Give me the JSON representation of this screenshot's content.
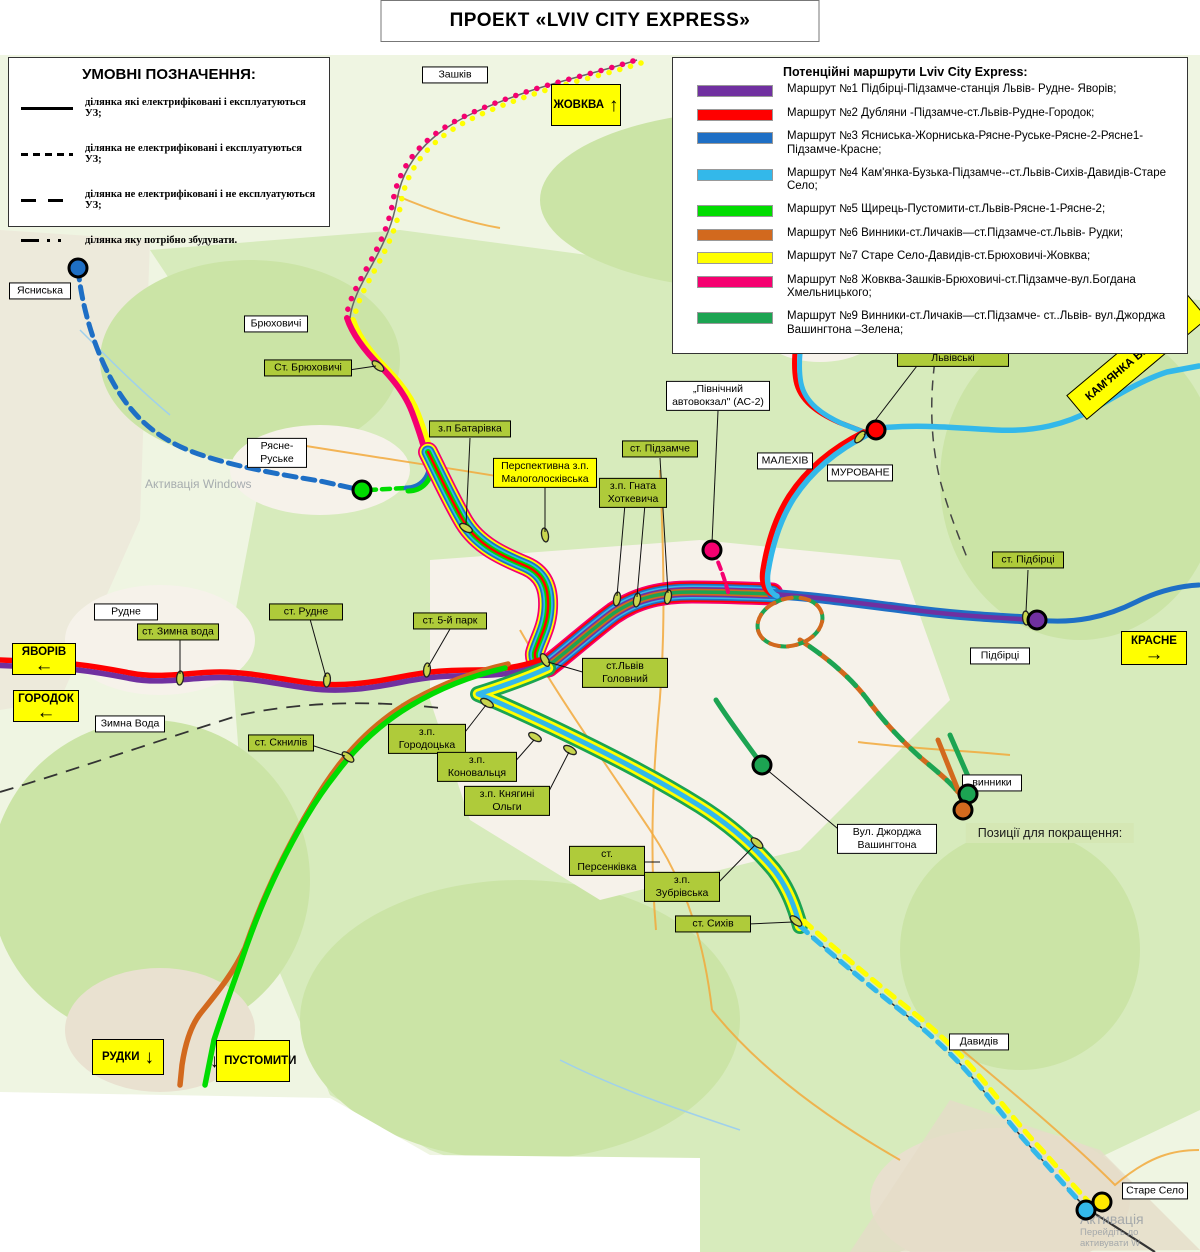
{
  "title": "ПРОЕКТ «LVIV CITY EXPRESS»",
  "legend": {
    "title": "УМОВНІ ПОЗНАЧЕННЯ:",
    "items": [
      {
        "style": "solid",
        "text": "ділянка які електрифіковані і експлуатуються УЗ;"
      },
      {
        "style": "dashed",
        "text": "ділянка не електрифіковані і експлуатуються УЗ;"
      },
      {
        "style": "longdash",
        "text": "ділянка не електрифіковані і не експлуатуються УЗ;"
      },
      {
        "style": "dashdot",
        "text": "ділянка яку потрібно збудувати."
      }
    ]
  },
  "routes_legend": {
    "title": "Потенційні маршрути  Lviv City Express:",
    "routes": [
      {
        "num": 1,
        "color": "#7030A0",
        "text": "Маршрут №1 Підбірці-Підзамче-станція Львів- Рудне- Яворів;"
      },
      {
        "num": 2,
        "color": "#FF0000",
        "text": "Маршрут №2 Дубляни -Підзамче-ст.Львів-Рудне-Городок;"
      },
      {
        "num": 3,
        "color": "#1E6FC5",
        "text": "Маршрут №3 Ясниська-Жорниська-Рясне-Руське-Рясне-2-Рясне1- Підзамче-Красне;"
      },
      {
        "num": 4,
        "color": "#33B8EA",
        "text": "Маршрут №4 Кам'янка-Бузька-Підзамче--ст.Львів-Сихів-Давидів-Старе Село;"
      },
      {
        "num": 5,
        "color": "#00DC00",
        "text": "Маршрут №5 Щирець-Пустомити-ст.Львів-Рясне-1-Рясне-2;"
      },
      {
        "num": 6,
        "color": "#D2691E",
        "text": "Маршрут №6 Винники-ст.Личаків—ст.Підзамче-ст.Львів- Рудки;"
      },
      {
        "num": 7,
        "color": "#FFFF00",
        "text": "Маршрут №7 Старе Село-Давидів-ст.Брюховичі-Жовква;"
      },
      {
        "num": 8,
        "color": "#F50070",
        "text": "Маршрут №8 Жовква-Зашків-Брюховичі-ст.Підзамче-вул.Богдана Хмельницького;"
      },
      {
        "num": 9,
        "color": "#1CA452",
        "text": "Маршрут №9 Винники-ст.Личаків—ст.Підзамче- ст..Львів- вул.Джорджа Вашингтона –Зелена;"
      }
    ]
  },
  "map": {
    "stations": [
      {
        "text": "Ст. Брюховичі",
        "x": 308,
        "y": 368,
        "w": 80
      },
      {
        "text": "з.п Батарівка",
        "x": 470,
        "y": 429,
        "w": 74
      },
      {
        "text": "Перспективна з.п. Малоголосківська",
        "x": 545,
        "y": 473,
        "w": 96,
        "kind": "persp"
      },
      {
        "text": "ст. Підзамче",
        "x": 660,
        "y": 449,
        "w": 68
      },
      {
        "text": "з.п. Гната Хоткевича",
        "x": 633,
        "y": 493,
        "w": 60
      },
      {
        "text": "з.п. Дубляни-Львівські",
        "x": 953,
        "y": 352,
        "w": 104
      },
      {
        "text": "ст. Підбірці",
        "x": 1028,
        "y": 560,
        "w": 64
      },
      {
        "text": "ст. Рудне",
        "x": 306,
        "y": 612,
        "w": 66
      },
      {
        "text": "ст. Зимна вода",
        "x": 178,
        "y": 632,
        "w": 74
      },
      {
        "text": "ст. 5-й парк",
        "x": 450,
        "y": 621,
        "w": 66
      },
      {
        "text": "ст.Львів Головний",
        "x": 625,
        "y": 673,
        "w": 78
      },
      {
        "text": "з.п. Городоцька",
        "x": 427,
        "y": 739,
        "w": 70
      },
      {
        "text": "з.п. Коновальця",
        "x": 477,
        "y": 767,
        "w": 72
      },
      {
        "text": "з.п. Княгині Ольги",
        "x": 507,
        "y": 801,
        "w": 78
      },
      {
        "text": "ст. Скнилів",
        "x": 281,
        "y": 743,
        "w": 58
      },
      {
        "text": "ст. Персенківка",
        "x": 607,
        "y": 861,
        "w": 68
      },
      {
        "text": "з.п. Зубрівська",
        "x": 682,
        "y": 887,
        "w": 68
      },
      {
        "text": "ст. Сихів",
        "x": 713,
        "y": 924,
        "w": 68
      }
    ],
    "places": [
      {
        "text": "Зашків",
        "x": 455,
        "y": 75,
        "w": 58
      },
      {
        "text": "Ясниська",
        "x": 40,
        "y": 291,
        "w": 54
      },
      {
        "text": "Брюховичі",
        "x": 276,
        "y": 324,
        "w": 56
      },
      {
        "text": "Рясне-Руське",
        "x": 277,
        "y": 453,
        "w": 52
      },
      {
        "text": "Дубляни",
        "x": 821,
        "y": 341,
        "w": 50
      },
      {
        "text": "„Північний автовокзал\" (АС-2)",
        "x": 718,
        "y": 396,
        "w": 96
      },
      {
        "text": "МАЛЕХІВ",
        "x": 785,
        "y": 461,
        "w": 48
      },
      {
        "text": "МУРОВАНЕ",
        "x": 860,
        "y": 473,
        "w": 58
      },
      {
        "text": "Рудне",
        "x": 126,
        "y": 612,
        "w": 56
      },
      {
        "text": "Зимна Вода",
        "x": 130,
        "y": 724,
        "w": 62
      },
      {
        "text": "Підбірці",
        "x": 1000,
        "y": 656,
        "w": 52
      },
      {
        "text": "Вул. Джорджа Вашингтона",
        "x": 887,
        "y": 839,
        "w": 92
      },
      {
        "text": "винники",
        "x": 992,
        "y": 783,
        "w": 52
      },
      {
        "text": "Давидів",
        "x": 979,
        "y": 1042,
        "w": 52
      },
      {
        "text": "Старе Село",
        "x": 1155,
        "y": 1191,
        "w": 58
      }
    ],
    "signs": [
      {
        "text": "ЖОВКВА",
        "x": 586,
        "y": 105,
        "w": 70,
        "h": 42,
        "arrow": "↑",
        "layout": "row"
      },
      {
        "text": "КАМ'ЯНКА БУЗЬКА",
        "x": 1137,
        "y": 357,
        "w": 158,
        "h": 32,
        "arrow": "↗",
        "layout": "row",
        "rotate": -40
      },
      {
        "text": "КРАСНЕ",
        "x": 1154,
        "y": 648,
        "w": 66,
        "h": 34,
        "arrow": "→",
        "layout": "col"
      },
      {
        "text": "ЯВОРІВ",
        "x": 44,
        "y": 659,
        "w": 64,
        "h": 32,
        "arrow": "←",
        "layout": "col"
      },
      {
        "text": "ГОРОДОК",
        "x": 46,
        "y": 706,
        "w": 66,
        "h": 32,
        "arrow": "←",
        "layout": "col"
      },
      {
        "text": "РУДКИ",
        "x": 128,
        "y": 1057,
        "w": 72,
        "h": 36,
        "arrow": "↓",
        "layout": "row"
      },
      {
        "text": "ПУСТОМИТИ",
        "x": 253,
        "y": 1061,
        "w": 74,
        "h": 42,
        "arrow": "↓",
        "layout": "row",
        "arrow_first": true
      }
    ],
    "note": {
      "text": "Позиції для покращення:",
      "x": 1050,
      "y": 833
    },
    "watermarks": {
      "mid": {
        "text": "Активація Windows",
        "x": 145,
        "y": 477
      },
      "corner": {
        "lines": [
          "Активація",
          "Перейдіть до",
          "активувати W"
        ],
        "x": 1190,
        "y": 1211
      }
    },
    "dots": [
      {
        "x": 78,
        "y": 268,
        "color": "#1E6FC5",
        "name": "yasnyska-terminal"
      },
      {
        "x": 362,
        "y": 490,
        "color": "#00DC00",
        "name": "riasne-terminal"
      },
      {
        "x": 876,
        "y": 430,
        "color": "#FF0000",
        "name": "dubliany-terminal"
      },
      {
        "x": 712,
        "y": 550,
        "color": "#F50070",
        "name": "ac2-terminal"
      },
      {
        "x": 1037,
        "y": 620,
        "color": "#7030A0",
        "name": "pidbirtsi-terminal"
      },
      {
        "x": 762,
        "y": 765,
        "color": "#1CA452",
        "name": "vashyngtona-terminal"
      },
      {
        "x": 968,
        "y": 794,
        "color": "#1CA452",
        "name": "vynnyky-green-terminal"
      },
      {
        "x": 963,
        "y": 810,
        "color": "#D2691E",
        "name": "vynnyky-orange-terminal"
      },
      {
        "x": 1086,
        "y": 1210,
        "color": "#33B8EA",
        "name": "stare-selo-cyan-terminal"
      },
      {
        "x": 1102,
        "y": 1202,
        "color": "#FFE800",
        "name": "stare-selo-yellow-terminal"
      }
    ],
    "markers": [
      {
        "x": 378,
        "y": 366,
        "a": 40
      },
      {
        "x": 466,
        "y": 528,
        "a": 30
      },
      {
        "x": 545,
        "y": 535,
        "a": 80
      },
      {
        "x": 617,
        "y": 599,
        "a": 100
      },
      {
        "x": 637,
        "y": 600,
        "a": 100
      },
      {
        "x": 668,
        "y": 597,
        "a": 100
      },
      {
        "x": 860,
        "y": 437,
        "a": 130
      },
      {
        "x": 1026,
        "y": 618,
        "a": 85
      },
      {
        "x": 327,
        "y": 680,
        "a": 95
      },
      {
        "x": 180,
        "y": 678,
        "a": 95
      },
      {
        "x": 427,
        "y": 670,
        "a": 95
      },
      {
        "x": 545,
        "y": 660,
        "a": 60
      },
      {
        "x": 487,
        "y": 703,
        "a": 30
      },
      {
        "x": 535,
        "y": 737,
        "a": 30
      },
      {
        "x": 570,
        "y": 750,
        "a": 30
      },
      {
        "x": 348,
        "y": 757,
        "a": 40
      },
      {
        "x": 757,
        "y": 843,
        "a": 40
      },
      {
        "x": 796,
        "y": 921,
        "a": 40
      }
    ]
  }
}
